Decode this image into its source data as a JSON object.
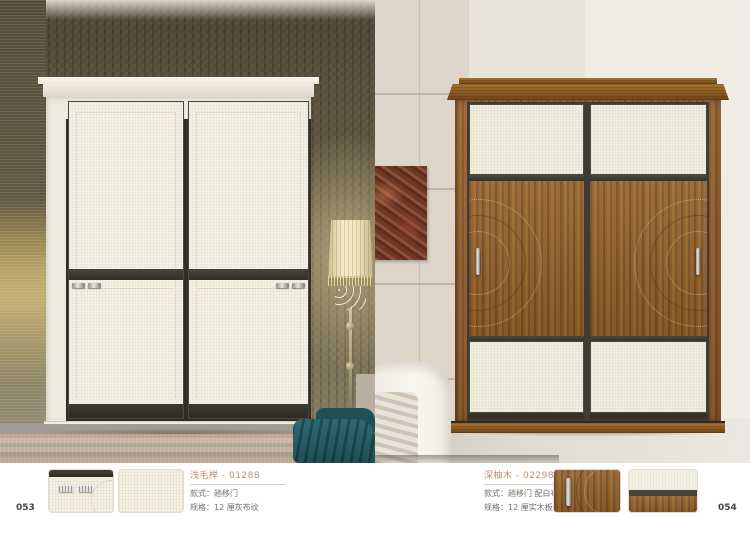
{
  "page": {
    "left_number": "053",
    "right_number": "054"
  },
  "left_product": {
    "title": "浅毛榉 - 01288",
    "style_line": "款式：趟移门",
    "spec_line": "规格：12 厘灰布纹"
  },
  "right_product": {
    "title": "深柚木 - 02298",
    "style_line": "款式：趟移门 配白布纹",
    "spec_line": "规格：12 厘实木板"
  },
  "colors": {
    "accent_title": "#b78f74",
    "wood": "#8a5a28",
    "panel_linen": "#f4f1e5",
    "wallpaper": "#675d45",
    "teal_accent": "#2a666e",
    "dark_gap": "#35332e"
  }
}
